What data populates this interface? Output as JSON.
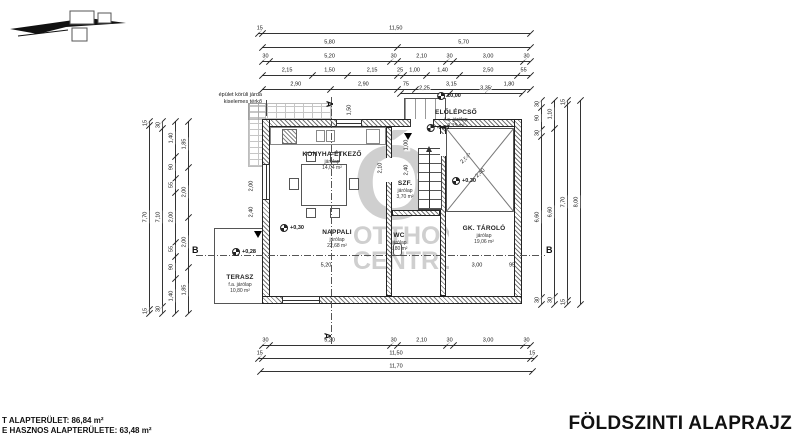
{
  "title": "FÖLDSZINTI ALAPRAJZ",
  "footer": {
    "line1": "T ALAPTERÜLET: 86,84 m²",
    "line2": "E HASZNOS ALAPTERÜLETE: 63,48 m²"
  },
  "watermark": {
    "glyph": "Ó",
    "line1": "OTTHON",
    "line2": "CENTRUM"
  },
  "note": {
    "line1": "épület körüli járda",
    "line2": "kiselemes térkő"
  },
  "rooms": [
    {
      "name": "KONYHA-ÉTKEZŐ",
      "floor": "járólap",
      "area": "14,04 m²",
      "x": 332,
      "y": 151
    },
    {
      "name": "NAPPALI",
      "floor": "járólap",
      "area": "22,68 m²",
      "x": 337,
      "y": 229
    },
    {
      "name": "SZF.",
      "floor": "járólap",
      "area": "3,70 m²",
      "x": 405,
      "y": 180
    },
    {
      "name": "WC",
      "floor": "járólap",
      "area": "1,80 m²",
      "x": 399,
      "y": 232
    },
    {
      "name": "GK. TÁROLÓ",
      "floor": "járólap",
      "area": "19,06 m²",
      "x": 484,
      "y": 225
    },
    {
      "name": "ELŐLÉPCSŐ",
      "floor": "f.a. járólap",
      "area": "3,15 m²",
      "x": 456,
      "y": 109
    },
    {
      "name": "TERASZ",
      "floor": "f.a. járólap",
      "area": "10,80 m²",
      "x": 240,
      "y": 274
    }
  ],
  "levels": [
    {
      "text": "±0,00",
      "x": 449,
      "y": 96
    },
    {
      "text": "-0,28",
      "x": 438,
      "y": 128
    },
    {
      "text": "+0,28",
      "x": 244,
      "y": 252
    },
    {
      "text": "+0,30",
      "x": 292,
      "y": 228
    },
    {
      "text": "+0,30",
      "x": 464,
      "y": 181
    }
  ],
  "sections": [
    {
      "label": "A",
      "x": 326,
      "y": 99,
      "rot": 90
    },
    {
      "label": "A",
      "x": 324,
      "y": 331,
      "rot": 90
    },
    {
      "label": "B",
      "x": 192,
      "y": 245,
      "rot": 0
    },
    {
      "label": "B",
      "x": 546,
      "y": 245,
      "rot": 0
    }
  ],
  "chains": [
    {
      "dir": "h",
      "x": 258,
      "y": 33,
      "len": 272,
      "segs": [
        "15",
        "11,50"
      ]
    },
    {
      "dir": "h",
      "x": 262,
      "y": 47,
      "len": 268,
      "segs": [
        "5,80",
        "5,70"
      ]
    },
    {
      "dir": "h",
      "x": 262,
      "y": 61,
      "len": 268,
      "segs": [
        "30",
        "5,20",
        "30",
        "2,10",
        "30",
        "3,00",
        "30"
      ]
    },
    {
      "dir": "h",
      "x": 262,
      "y": 75,
      "len": 268,
      "segs": [
        "2,15",
        "1,50",
        "2,15",
        "25",
        "1,00",
        "1,40",
        "2,50",
        "55"
      ]
    },
    {
      "dir": "h",
      "x": 262,
      "y": 89,
      "len": 268,
      "segs": [
        "2,90",
        "2,90",
        "75",
        "3,15",
        "1,80"
      ]
    },
    {
      "dir": "h",
      "x": 400,
      "y": 93,
      "len": 122,
      "segs": [
        "2,25",
        "3,35"
      ]
    },
    {
      "dir": "h",
      "x": 262,
      "y": 345,
      "len": 268,
      "segs": [
        "30",
        "5,20",
        "30",
        "2,10",
        "30",
        "3,00",
        "30"
      ]
    },
    {
      "dir": "h",
      "x": 258,
      "y": 358,
      "len": 276,
      "segs": [
        "15",
        "11,50",
        "15"
      ]
    },
    {
      "dir": "h",
      "x": 260,
      "y": 371,
      "len": 272,
      "segs": [
        "11,70"
      ]
    },
    {
      "dir": "v",
      "x": 149,
      "y": 121,
      "len": 192,
      "segs": [
        "15",
        "7,70",
        "15"
      ]
    },
    {
      "dir": "v",
      "x": 162,
      "y": 121,
      "len": 192,
      "segs": [
        "30",
        "7,10",
        "30"
      ]
    },
    {
      "dir": "v",
      "x": 175,
      "y": 121,
      "len": 192,
      "segs": [
        "1,40",
        "90",
        "55",
        "2,00",
        "55",
        "90",
        "1,40"
      ]
    },
    {
      "dir": "v",
      "x": 188,
      "y": 121,
      "len": 192,
      "segs": [
        "1,85",
        "2,00",
        "2,00",
        "1,85"
      ]
    },
    {
      "dir": "v",
      "x": 541,
      "y": 100,
      "len": 204,
      "segs": [
        "30",
        "90",
        "30",
        "6,60",
        "30"
      ]
    },
    {
      "dir": "v",
      "x": 554,
      "y": 100,
      "len": 204,
      "segs": [
        "1,10",
        "6,60",
        "30"
      ]
    },
    {
      "dir": "v",
      "x": 567,
      "y": 100,
      "len": 204,
      "segs": [
        "15",
        "7,70",
        "15"
      ]
    },
    {
      "dir": "v",
      "x": 580,
      "y": 100,
      "len": 204,
      "segs": [
        "8,00"
      ]
    }
  ],
  "float_dims": [
    {
      "text": "1,50",
      "x": 350,
      "y": 110,
      "rot": -90
    },
    {
      "text": "2,10",
      "x": 381,
      "y": 168,
      "rot": -90
    },
    {
      "text": "2,40",
      "x": 407,
      "y": 170,
      "rot": -90
    },
    {
      "text": "1,10",
      "x": 428,
      "y": 190,
      "rot": -90
    },
    {
      "text": "1,00",
      "x": 407,
      "y": 145,
      "rot": -90
    },
    {
      "text": "75",
      "x": 421,
      "y": 176,
      "rot": 0
    },
    {
      "text": "45",
      "x": 266,
      "y": 266,
      "rot": 0
    },
    {
      "text": "5,20",
      "x": 326,
      "y": 266,
      "rot": 0
    },
    {
      "text": "3,00",
      "x": 477,
      "y": 266,
      "rot": 0
    },
    {
      "text": "95",
      "x": 512,
      "y": 266,
      "rot": 0
    },
    {
      "text": "2,00",
      "x": 233,
      "y": 270,
      "rot": 0
    },
    {
      "text": "90",
      "x": 257,
      "y": 266,
      "rot": 0
    },
    {
      "text": "5,00",
      "x": 250,
      "y": 248,
      "rot": -90
    },
    {
      "text": "2,40",
      "x": 252,
      "y": 212,
      "rot": -90
    },
    {
      "text": "2,00",
      "x": 252,
      "y": 186,
      "rot": -90
    },
    {
      "text": "2,50",
      "x": 466,
      "y": 160,
      "rot": -42
    },
    {
      "text": "2,40",
      "x": 481,
      "y": 174,
      "rot": -42
    },
    {
      "text": "▽",
      "x": 468,
      "y": 156,
      "rot": 0
    }
  ]
}
